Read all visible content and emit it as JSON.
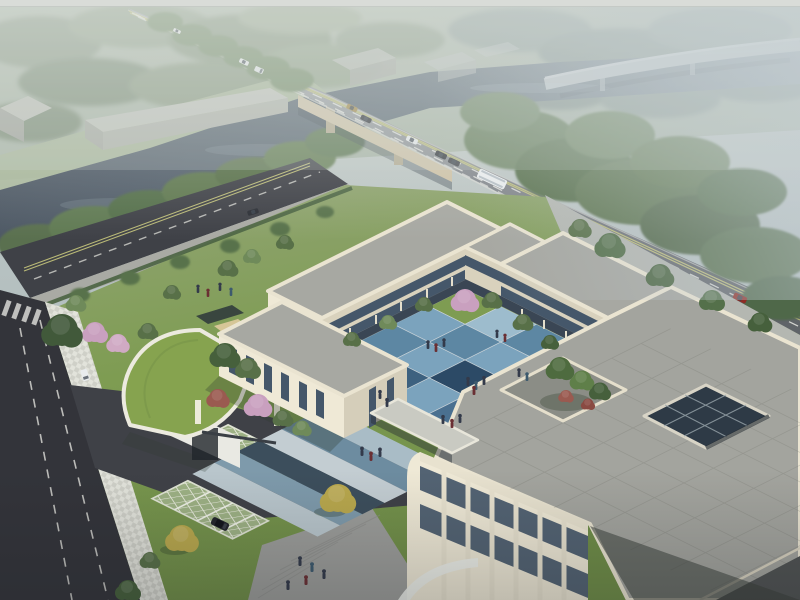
{
  "scene": {
    "type": "aerial-architectural-rendering",
    "description": "High oblique bird's-eye rendering of a three-storey cream stone campus built around a blue checkerboard courtyard. A hazy river crossed by a highway bridge runs behind the site, with warehouses, dense trees, a distant curved viaduct, a local street with an entrance gate, a curved green-roof gatehouse, grass-grid parking bays with black SUVs, a roof terrace with a planted square and a glazed light-well, and small groups of people on the plazas.",
    "time_of_day": "hazy daylight",
    "camera": "high oblique aerial view"
  },
  "palette": {
    "sky_top": "#cdd2cc",
    "sky_mid": "#b6c1c1",
    "sky_low": "#a3b2b2",
    "fog": "#c3cdd4",
    "far_tree": "#8b9a86",
    "far_tree_dark": "#7d8e78",
    "meadow": "#a9b79a",
    "river_far": "#8c9aa6",
    "river_near": "#4d5864",
    "viaduct": "#c9d0d5",
    "warehouse_roof": "#bcbfb7",
    "warehouse_wall": "#a0a39b",
    "road_far": "#a8adb1",
    "road_near": "#606469",
    "bridge_fascia": "#cfc3a8",
    "bridge_pier": "#b3a98f",
    "lane_dash": "#e6e6e2",
    "lane_yellow": "#c6c67c",
    "street_asphalt": "#3f4147",
    "street_asphalt_dark": "#33343a",
    "sidewalk": "#a9aaa4",
    "checker_light": "#e2e3db",
    "checker_dark": "#cfd0c8",
    "lawn": "#7e9c52",
    "lawn_hazy": "#93a577",
    "hedge": "#4a6342",
    "green_roof": "#86a34f",
    "tree_green": "#587048",
    "tree_dark": "#46603c",
    "tree_light": "#6f8a5a",
    "tree_yellow": "#b9a84d",
    "tree_pink": "#c9a0bf",
    "tree_red": "#9a5a50",
    "wall_lit": "#efe9d6",
    "wall_shaded": "#d9d2bd",
    "wall_white": "#e9e9e3",
    "window_dark": "#45576a",
    "roof_slab": "#a7a8a2",
    "roof_parapet": "#eae4d1",
    "terrace_paver": "#a3a49e",
    "atrium_glass": "#2e3a46",
    "plaza": "#9c9d9a",
    "parking_paver": "#9db184",
    "parking_grid": "#e6e9da",
    "suv_black": "#23262c",
    "car_white": "#e9ecee",
    "car_red": "#8e2b24",
    "car_gold": "#a08648",
    "car_dark": "#2b2e35",
    "bus_white": "#eceff0",
    "people_dark": "#333a4a",
    "people_red": "#6a2f33",
    "people_blue": "#3d5a6e",
    "sand": "#d6c697"
  },
  "courtyard": {
    "paving": "blue checkerboard tiles with grass strips along the inner facades",
    "tile_colors": [
      "#7e9c52",
      "#9dbccd",
      "#5d87a3",
      "#2c4a66",
      "#7ba3bd",
      "#5d87a3",
      "#7ba3bd",
      "#3d617f",
      "#5d87a3",
      "#7ba3bd",
      "#2c4a66",
      "#5d87a3",
      "#9dbccd",
      "#3d617f",
      "#7ba3bd",
      "#4a7090"
    ]
  },
  "walkway": {
    "stripe_colors": [
      "#a9bcc6",
      "#6d8ca0",
      "#c3cdd2",
      "#3c4e5c",
      "#7e9aab",
      "#b9c6cc"
    ]
  },
  "buildings": {
    "campus": {
      "storeys": 3,
      "facade": "cream stone with dark vertical and horizontal window strips",
      "roofs": "grey paved slabs with rounded cream parapets",
      "features": [
        "U-shaped wings around blue courtyard",
        "ground-floor colonnade",
        "roof terrace with tree planter",
        "square glazed light-well",
        "single-storey link corridor",
        "curved green-roof gatehouse"
      ]
    },
    "context": [
      "grey gabled warehouses along the river",
      "highway bridge over river",
      "distant curved viaduct in fog"
    ]
  },
  "vehicles": {
    "highway": [
      "white car",
      "white car",
      "white van",
      "gold car",
      "dark car",
      "white car",
      "dark car",
      "dark car",
      "white bus",
      "white car",
      "red car",
      "red car"
    ],
    "frontage_street": [
      "dark car"
    ],
    "local_street": [
      "white van",
      "dark car"
    ],
    "parking": [
      "black suv",
      "black suv",
      "black suv"
    ]
  },
  "people_groups": [
    {
      "location": "north lawn",
      "count": 4
    },
    {
      "location": "central courtyard",
      "count": 15
    },
    {
      "location": "entrance walkway",
      "count": 4
    },
    {
      "location": "south plaza",
      "count": 5
    }
  ],
  "landscape": {
    "river": "dark grey-blue canal fading into fog",
    "trees": [
      "green",
      "dark green",
      "pink blossom",
      "yellow",
      "red-leaf"
    ],
    "parking_surface": "grass-grid permeable pavers",
    "paths": "checkerboard pavers along local street"
  }
}
